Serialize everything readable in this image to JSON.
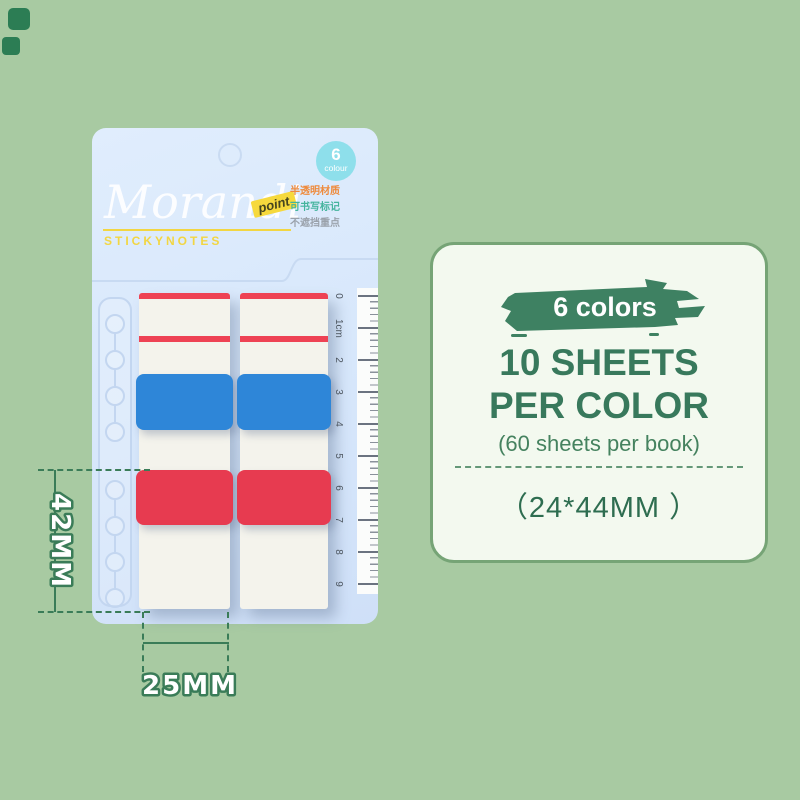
{
  "background_color": "#a8caa2",
  "decor": {
    "corner_square_color": "#2c7d54"
  },
  "package": {
    "brand": "Morandi",
    "subtitle": "STICKYNOTES",
    "point_tag": "point",
    "badge": {
      "number": "6",
      "label": "colour"
    },
    "features": [
      "半透明材质",
      "可书写标记",
      "不遮挡重点"
    ],
    "ruler": {
      "marks": [
        "0",
        "1cm",
        "2",
        "3",
        "4",
        "5",
        "6",
        "7",
        "8",
        "9"
      ]
    },
    "colors": {
      "card_bg": "#d7e7fb",
      "tab_white": "#f4f3ec",
      "stripe_red": "#ee4254",
      "tab_blue": "#2e86d8",
      "tab_red": "#e73b50",
      "badge_cyan": "#8edfeb",
      "accent_yellow": "#f2d643"
    }
  },
  "annotations": {
    "height_label": "42MM",
    "width_label": "25MM",
    "line_color": "#3a7c58"
  },
  "info_panel": {
    "badge_label": "6 colors",
    "headline_line1": "10 SHEETS",
    "headline_line2": "PER COLOR",
    "subline": "(60 sheets per book)",
    "size_label": "（24*44MM ）",
    "colors": {
      "panel_bg": "#f3f9ef",
      "panel_border": "#76a476",
      "text_green": "#38795c",
      "brush_green": "#3e8162"
    }
  }
}
